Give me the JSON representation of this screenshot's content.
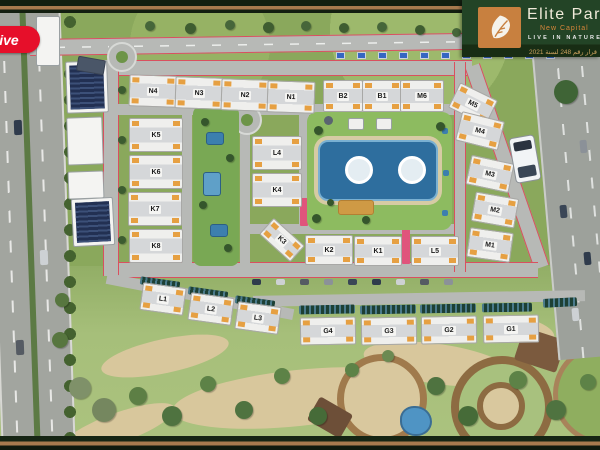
{
  "watermark": {
    "label": "live"
  },
  "logo": {
    "brand": "Elite Park",
    "subtitle": "New Capital",
    "tagline": "LIVE IN NATURE",
    "license": "قرار رقم 248 لسنة 2021"
  },
  "masterplan": {
    "buildings": [
      {
        "label": "N4",
        "x": 152,
        "y": 90,
        "w": 46,
        "h": 30,
        "r": 2
      },
      {
        "label": "N3",
        "x": 198,
        "y": 92,
        "w": 46,
        "h": 30,
        "r": 2
      },
      {
        "label": "N2",
        "x": 244,
        "y": 94,
        "w": 46,
        "h": 30,
        "r": 2
      },
      {
        "label": "N1",
        "x": 290,
        "y": 96,
        "w": 46,
        "h": 30,
        "r": 2
      },
      {
        "label": "B2",
        "x": 342,
        "y": 95,
        "w": 38,
        "h": 30,
        "r": 0
      },
      {
        "label": "B1",
        "x": 381,
        "y": 95,
        "w": 38,
        "h": 30,
        "r": 0
      },
      {
        "label": "M6",
        "x": 421,
        "y": 95,
        "w": 42,
        "h": 30,
        "r": 0
      },
      {
        "label": "M5",
        "x": 472,
        "y": 103,
        "w": 40,
        "h": 26,
        "r": 26
      },
      {
        "label": "M4",
        "x": 479,
        "y": 130,
        "w": 42,
        "h": 28,
        "r": 14
      },
      {
        "label": "M3",
        "x": 489,
        "y": 173,
        "w": 42,
        "h": 28,
        "r": 12
      },
      {
        "label": "M2",
        "x": 494,
        "y": 209,
        "w": 42,
        "h": 28,
        "r": 10
      },
      {
        "label": "M1",
        "x": 489,
        "y": 244,
        "w": 42,
        "h": 28,
        "r": 8
      },
      {
        "label": "K5",
        "x": 155,
        "y": 134,
        "w": 52,
        "h": 32,
        "r": 0
      },
      {
        "label": "K6",
        "x": 155,
        "y": 171,
        "w": 52,
        "h": 32,
        "r": 0
      },
      {
        "label": "K7",
        "x": 154,
        "y": 208,
        "w": 52,
        "h": 32,
        "r": 0
      },
      {
        "label": "K8",
        "x": 155,
        "y": 245,
        "w": 52,
        "h": 32,
        "r": 0
      },
      {
        "label": "L4",
        "x": 276,
        "y": 152,
        "w": 48,
        "h": 32,
        "r": 0
      },
      {
        "label": "K4",
        "x": 276,
        "y": 189,
        "w": 48,
        "h": 32,
        "r": 0
      },
      {
        "label": "K3",
        "x": 281,
        "y": 239,
        "w": 40,
        "h": 20,
        "r": 42
      },
      {
        "label": "K2",
        "x": 328,
        "y": 249,
        "w": 46,
        "h": 28,
        "r": 0
      },
      {
        "label": "K1",
        "x": 377,
        "y": 250,
        "w": 46,
        "h": 28,
        "r": 0
      },
      {
        "label": "L5",
        "x": 434,
        "y": 250,
        "w": 46,
        "h": 28,
        "r": 0
      },
      {
        "label": "L1",
        "x": 162,
        "y": 298,
        "w": 42,
        "h": 26,
        "r": 8
      },
      {
        "label": "L2",
        "x": 210,
        "y": 308,
        "w": 42,
        "h": 26,
        "r": 8
      },
      {
        "label": "L3",
        "x": 257,
        "y": 317,
        "w": 42,
        "h": 26,
        "r": 8
      },
      {
        "label": "G4",
        "x": 327,
        "y": 330,
        "w": 54,
        "h": 26,
        "r": -1
      },
      {
        "label": "G3",
        "x": 388,
        "y": 330,
        "w": 54,
        "h": 26,
        "r": -1
      },
      {
        "label": "G2",
        "x": 448,
        "y": 329,
        "w": 54,
        "h": 26,
        "r": -1
      },
      {
        "label": "G1",
        "x": 510,
        "y": 328,
        "w": 54,
        "h": 26,
        "r": -1
      }
    ]
  },
  "colors": {
    "frame_green": "#131f10",
    "frame_stripe": "#a87a4e",
    "logo_background": "#234426",
    "leaf_box_orange": "#c8803f",
    "brand_text": "#f0ead9",
    "subtitle_orange": "#d8863a",
    "badge_red": "#e60f2a",
    "grass": "#8aa85c",
    "park_grass": "#a6bf7a",
    "road_gray": "#b7b9b6",
    "track_red": "#d9505f",
    "pool_blue": "#2e6e9e",
    "building_white": "#efefed",
    "unit_orange": "#e6a042",
    "solar_navy": "#223052",
    "canopy_dark": "#1d4034"
  }
}
